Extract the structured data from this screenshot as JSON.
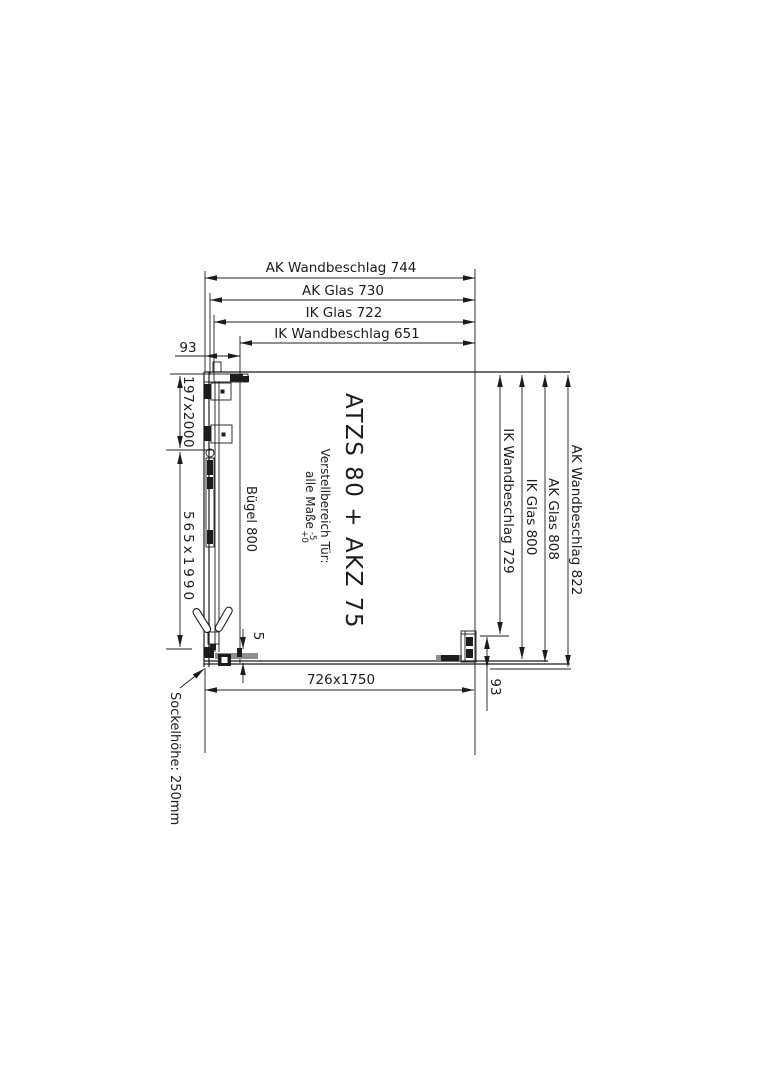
{
  "drawing": {
    "product_title": "ATZS 80 + AKZ 75",
    "adjustment_note": {
      "line1": "Verstellbereich Tür:",
      "line2_prefix": "alle Maße",
      "tolerance_upper": "-5",
      "tolerance_lower": "+0"
    },
    "top_dimensions": {
      "ak_wandbeschlag": "AK Wandbeschlag 744",
      "ak_glas": "AK Glas 730",
      "ik_glas": "IK Glas 722",
      "ik_wandbeschlag": "IK Wandbeschlag 651",
      "wall_offset": "93"
    },
    "right_dimensions": {
      "ik_wandbeschlag": "IK Wandbeschlag 729",
      "ik_glas": "IK Glas 800",
      "ak_glas": "AK Glas 808",
      "ak_wandbeschlag": "AK Wandbeschlag 822",
      "wall_offset": "93"
    },
    "left_dimensions": {
      "fixed_panel_size": "197x2000",
      "door_panel_size": "565x1990",
      "handle_label": "Bügel 800"
    },
    "bottom_dimensions": {
      "side_panel_size": "726x1750",
      "gap": "5"
    },
    "base_note": "Sockelhöhe: 250mm",
    "colors": {
      "line": "#1c1c1c",
      "profile_gray": "#8d8d8d",
      "background": "#ffffff"
    }
  }
}
